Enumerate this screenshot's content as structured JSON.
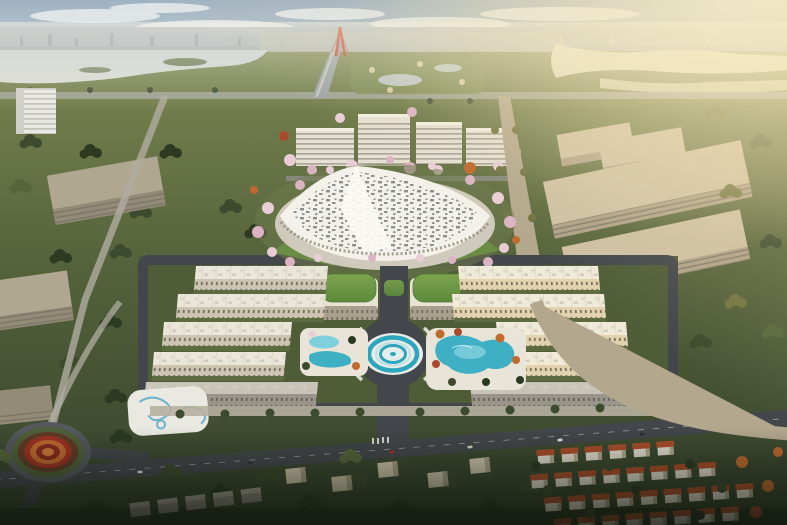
{
  "image": {
    "kind": "aerial-architectural-rendering",
    "alt": "Golden-hour aerial rendering of a master-planned district: a white speckled lotus dome at the center surrounded by cherry blossoms, twin green-roofed pavilions, a circular teal plaza emblem flanked by lagoon pools, perimeter rows of cream townhouses, office blocks and beige industrial halls beyond, lakes, a red cable-stayed bridge on the horizon, a flower roundabout and red-roofed villas in the shaded foreground."
  },
  "colors": {
    "sky_top": "#9fb2c2",
    "sky_horizon": "#e6e9e4",
    "cloud": "#f1f3f2",
    "sun_core": "#fffbe6",
    "sun_glow": "#f8e9bd",
    "warm_cast": "#f3dda6",
    "haze": "#f4f1e4",
    "distant_city": "#a7b0b6",
    "lake": "#c6cfd0",
    "river_warm": "#e6dfc6",
    "terrain_top": "#7c8752",
    "terrain_mid": "#55633c",
    "terrain_deep": "#33402a",
    "tree": "#3c4b2d",
    "tree_dark": "#2c3a22",
    "forest_floor": "#27331f",
    "blossom": "#e9cdd6",
    "blossom_deep": "#dbb4c4",
    "autumn_orange": "#c06a2e",
    "autumn_red": "#a84a2c",
    "road": "#43464a",
    "road_light": "#b3a88e",
    "path": "#d8d2c0",
    "bridge_red": "#c8402e",
    "dome": "#f3f1e9",
    "dome_rim": "#cfcabb",
    "dome_speckle": "#70767a",
    "campus_wall": "#e6e0d2",
    "tower_white": "#e9e9e3",
    "office": "#b0a791",
    "industrial": "#cec0a4",
    "townhouse_roof": "#eae6d9",
    "townhouse_facade": "#cdc4b1",
    "townhouse_sun": "#e3d2ae",
    "green_roof": "#7da44e",
    "green_roof_dark": "#5d8a3c",
    "lawn": "#6f9a43",
    "deck": "#e8e5d8",
    "pool": "#7fd0dd",
    "lagoon": "#3fb0c4",
    "plaza_teal": "#2ba6bd",
    "plaza_light": "#e9ebe6",
    "swirl_blue": "#5aa8c8",
    "flower_ring_red": "#9e3122",
    "flower_ring_orange": "#c06a2e",
    "flower_ring_dark": "#5f3a24",
    "villa_wall": "#e6e0d2",
    "villa_roof": "#ad4e2a",
    "vignette": "#10150d"
  }
}
